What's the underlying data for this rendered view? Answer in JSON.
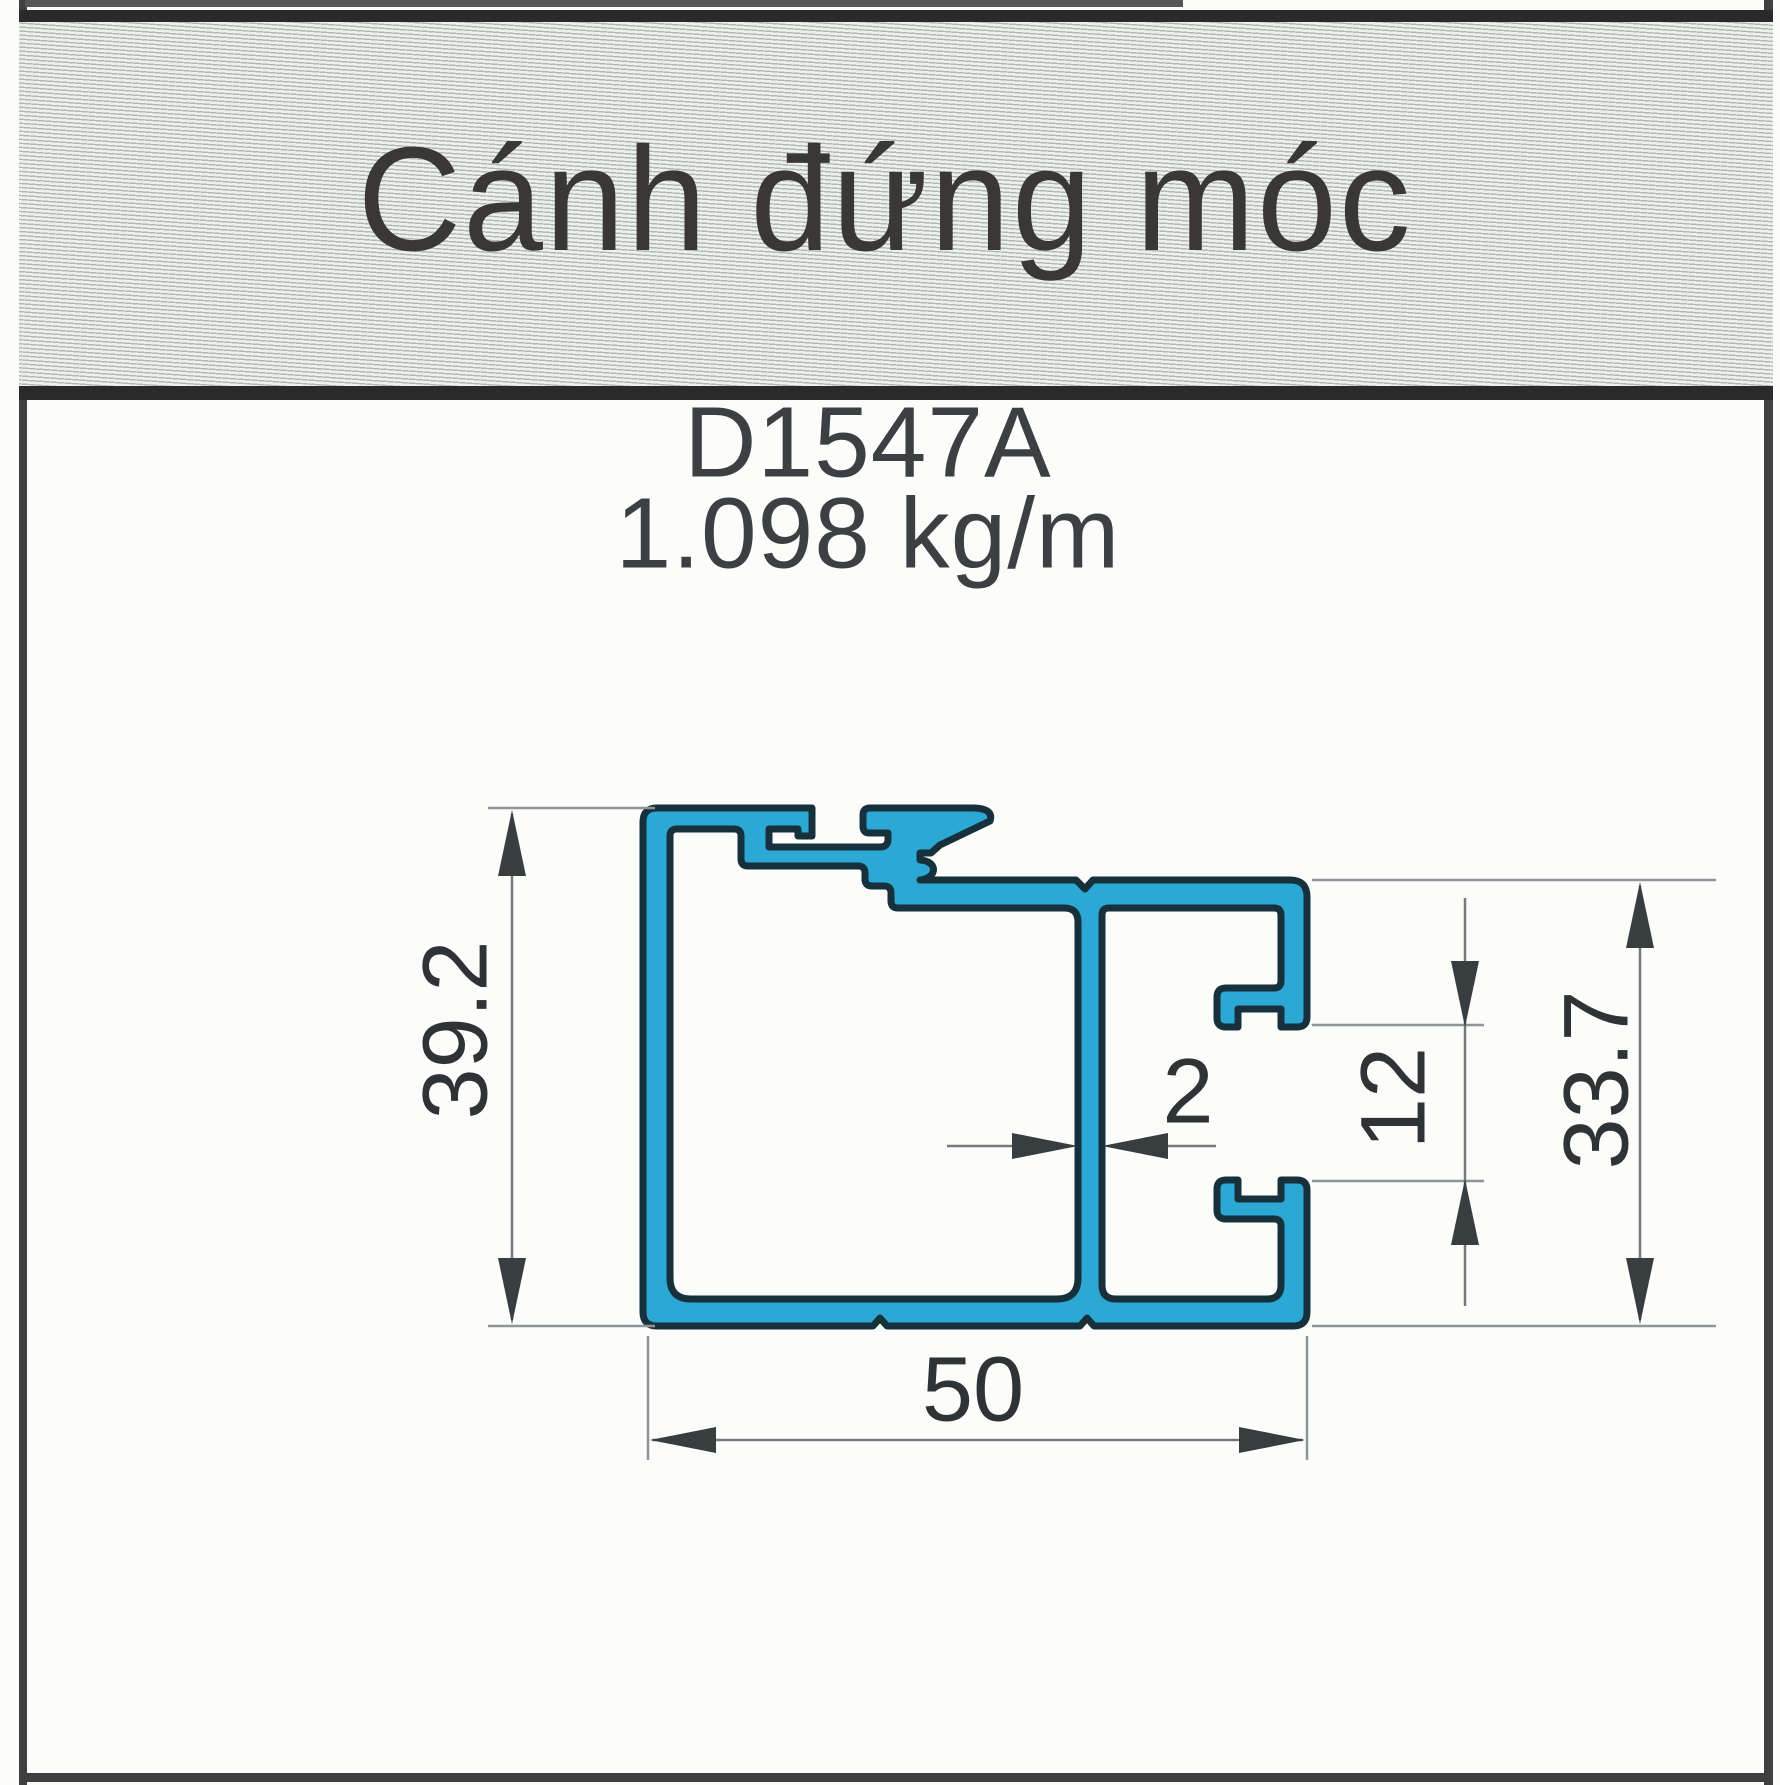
{
  "header": {
    "title": "Cánh đứng móc"
  },
  "product": {
    "code": "D1547A",
    "weight": "1.098 kg/m"
  },
  "dimensions": {
    "overall_height": "39.2",
    "overall_width": "50",
    "wall_thickness": "2",
    "channel_opening": "12",
    "right_height": "33.7"
  },
  "colors": {
    "profile_fill": "#2BA8D4",
    "profile_outline": "#16303C",
    "dimension_ink": "#2E3336",
    "header_border": "#2A2A2A"
  }
}
